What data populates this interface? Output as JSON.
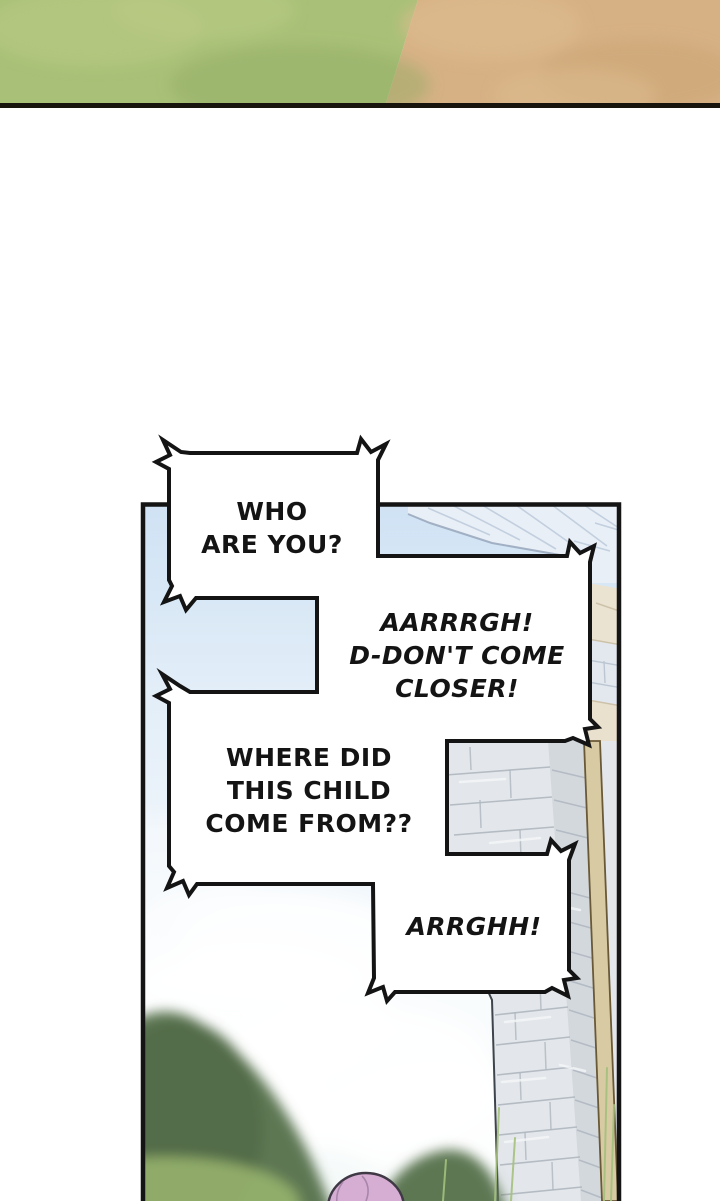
{
  "page": {
    "kind": "webtoon comic page"
  },
  "speech_bubbles": [
    {
      "id": "who-are-you",
      "style": "normal",
      "lines": [
        "WHO",
        "ARE YOU?"
      ]
    },
    {
      "id": "dont-come-closer",
      "style": "italic",
      "lines": [
        "AARRRGH!",
        "D-DON'T COME",
        "CLOSER!"
      ]
    },
    {
      "id": "where-did-child",
      "style": "normal",
      "lines": [
        "WHERE DID",
        "THIS CHILD",
        "COME FROM??"
      ]
    },
    {
      "id": "arrghh",
      "style": "italic",
      "lines": [
        "ARRGHH!"
      ]
    }
  ],
  "colors": {
    "ink": "#141414",
    "bubble-fill": "#ffffff",
    "strip-grass": "#a8c077",
    "strip-dirt": "#d6b184",
    "strip-line": "#17130d",
    "sky-top": "#cfe2f4",
    "sky-bottom": "#f5faf9",
    "cloud": "#ffffff",
    "ledge": "#e9eff6",
    "band-beige": "#ebe3d2",
    "wall-light": "#e3e7eb",
    "wall-shade": "#d3d8dd",
    "mortar": "#aeb6bf",
    "beam": "#d8cba4",
    "beam-edge": "#6a5937",
    "hill-dark": "#5d7752",
    "hill-light": "#97b26d",
    "head-pink": "#d7aed3",
    "head-outline": "#3f3845"
  }
}
